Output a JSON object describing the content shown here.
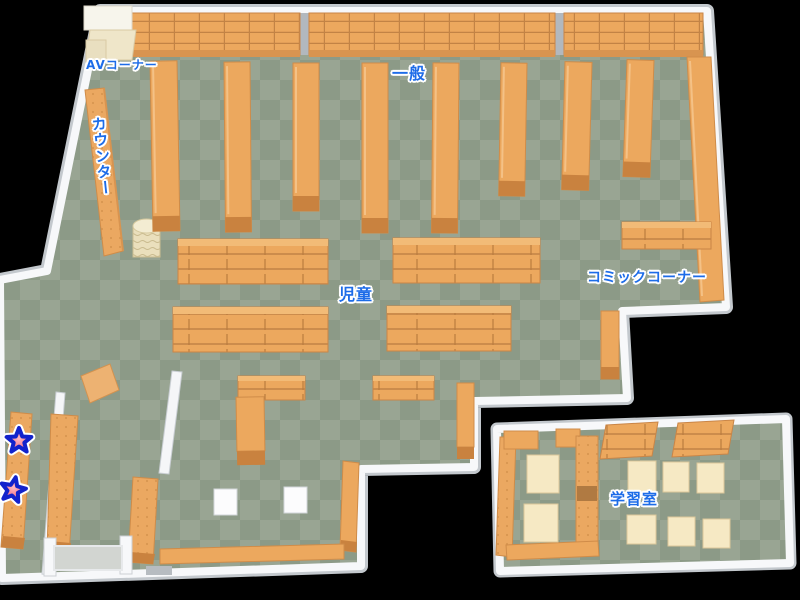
{
  "map": {
    "name": "library-floor-map",
    "areas": {
      "av_corner": {
        "label": "AVコーナー"
      },
      "counter": {
        "label": "カウンター"
      },
      "general": {
        "label": "一般"
      },
      "children": {
        "label": "児童"
      },
      "comic_corner": {
        "label": "コミックコーナー"
      },
      "study_room": {
        "label": "学習室"
      }
    },
    "markers": [
      {
        "name": "star-marker-1",
        "shape": "star"
      },
      {
        "name": "star-marker-2",
        "shape": "star"
      }
    ],
    "colors": {
      "floor_light": "#99a593",
      "floor_dark": "#8c9a87",
      "shelf_orange": "#eca85e",
      "shelf_edge": "#cf8c49",
      "shelf_base": "#c9823f",
      "wall_white": "#f7f8fa",
      "wall_gray": "#c3c8cd",
      "cream_shelf": "#efe6c9",
      "table_cream": "#f6e9c4",
      "label_blue": "#1d6ce8",
      "star_fill": "#ee4f68",
      "star_outline": "#1222cc"
    }
  }
}
